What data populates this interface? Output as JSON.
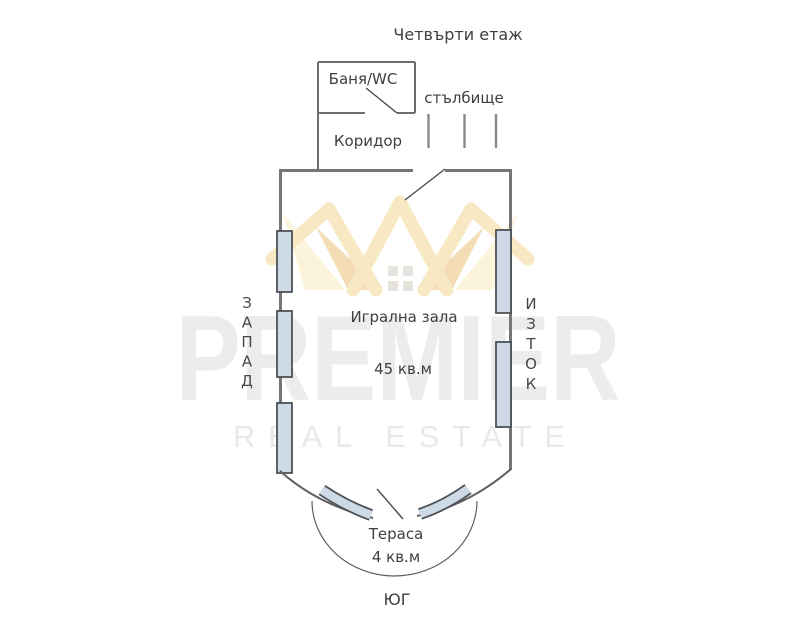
{
  "plan": {
    "title": "Четвърти етаж",
    "rooms": {
      "bath": {
        "label": "Баня/WC"
      },
      "corridor": {
        "label": "Коридор"
      },
      "stairs": {
        "label": "стълбище"
      },
      "hall": {
        "label": "Игрална зала",
        "area": "45 кв.м"
      },
      "terrace": {
        "label": "Тераса",
        "area": "4 кв.м"
      }
    },
    "compass": {
      "west": {
        "word": "ЗАПАД",
        "letters": [
          "З",
          "А",
          "П",
          "А",
          "Д"
        ]
      },
      "east": {
        "word": "ИЗТОК",
        "letters": [
          "И",
          "З",
          "Т",
          "О",
          "К"
        ]
      },
      "south": {
        "word": "ЮГ"
      }
    },
    "colors": {
      "wall": "#767676",
      "door_line": "#4a4a4a",
      "window_fill": "#cddae5",
      "window_border": "#4d5257",
      "label_text": "#3c4043",
      "background": "#ffffff"
    }
  },
  "watermark": {
    "brand": "PREMIER",
    "tagline": "REAL ESTATE",
    "brand_color": "#ececec",
    "logo_gold": "#f8e9c4",
    "logo_peach": "#f4dcb4",
    "logo_cream": "#fbf3da",
    "logo_squares": "#e5e3dc"
  }
}
